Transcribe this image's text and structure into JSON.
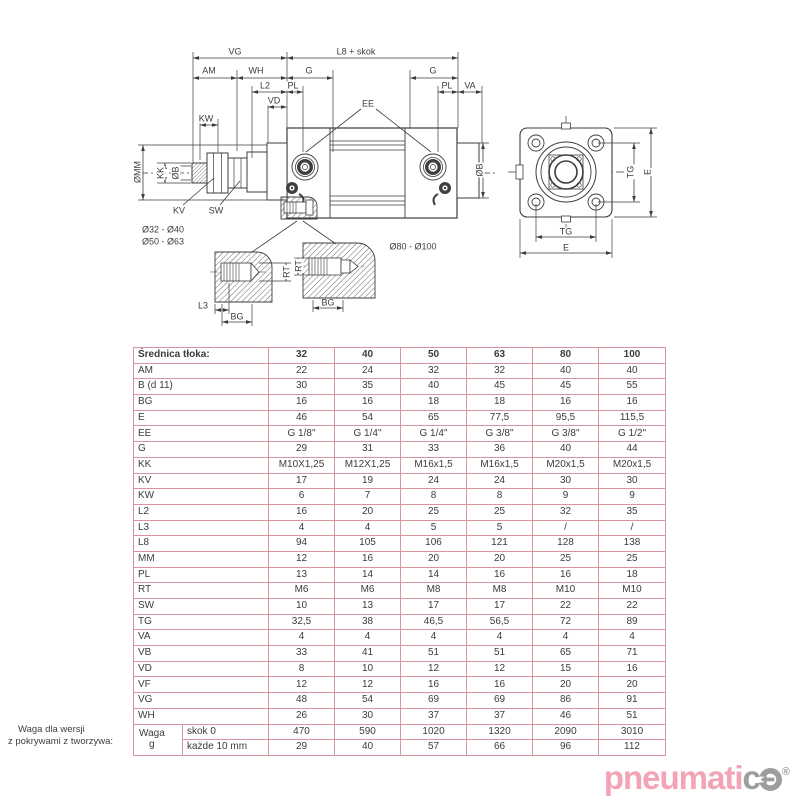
{
  "colors": {
    "line": "#3d3d3d",
    "table_border": "#d9949e",
    "text": "#3c3c3c",
    "logo_pink": "#f3a3b5",
    "logo_gray": "#9d9d9c"
  },
  "diagram": {
    "labels": [
      {
        "text": "VG",
        "x": 235,
        "y": 52
      },
      {
        "text": "L8 + skok",
        "x": 356,
        "y": 52
      },
      {
        "text": "AM",
        "x": 209,
        "y": 71
      },
      {
        "text": "WH",
        "x": 256,
        "y": 71
      },
      {
        "text": "G",
        "x": 309,
        "y": 71
      },
      {
        "text": "G",
        "x": 433,
        "y": 71
      },
      {
        "text": "L2",
        "x": 265,
        "y": 86
      },
      {
        "text": "PL",
        "x": 293,
        "y": 86
      },
      {
        "text": "PL",
        "x": 447,
        "y": 86
      },
      {
        "text": "VA",
        "x": 470,
        "y": 86
      },
      {
        "text": "VD",
        "x": 274,
        "y": 101
      },
      {
        "text": "KW",
        "x": 206,
        "y": 119
      },
      {
        "text": "EE",
        "x": 368,
        "y": 104
      },
      {
        "text": "ØMM",
        "x": 138,
        "y": 172,
        "rot": true
      },
      {
        "text": "KK",
        "x": 161,
        "y": 173,
        "rot": true
      },
      {
        "text": "ØB",
        "x": 176,
        "y": 173,
        "rot": true
      },
      {
        "text": "KV",
        "x": 179,
        "y": 211
      },
      {
        "text": "SW",
        "x": 216,
        "y": 211
      },
      {
        "text": "Ø32 - Ø40",
        "x": 163,
        "y": 230
      },
      {
        "text": "Ø50 - Ø63",
        "x": 163,
        "y": 242
      },
      {
        "text": "Ø80 - Ø100",
        "x": 413,
        "y": 247
      },
      {
        "text": "ØB",
        "x": 480,
        "y": 170,
        "rot": true
      },
      {
        "text": "TG",
        "x": 631,
        "y": 172,
        "rot": true
      },
      {
        "text": "E",
        "x": 648,
        "y": 172,
        "rot": true
      },
      {
        "text": "TG",
        "x": 566,
        "y": 232
      },
      {
        "text": "E",
        "x": 566,
        "y": 248
      },
      {
        "text": "RT",
        "x": 287,
        "y": 272,
        "rot": true
      },
      {
        "text": "RT",
        "x": 299,
        "y": 266,
        "rot": true
      },
      {
        "text": "L3",
        "x": 203,
        "y": 306
      },
      {
        "text": "BG",
        "x": 237,
        "y": 317
      },
      {
        "text": "BG",
        "x": 328,
        "y": 303
      }
    ]
  },
  "table": {
    "header": [
      "Średnica tłoka:",
      "32",
      "40",
      "50",
      "63",
      "80",
      "100"
    ],
    "rows": [
      {
        "label": "AM",
        "values": [
          "22",
          "24",
          "32",
          "32",
          "40",
          "40"
        ]
      },
      {
        "label": "B (d 11)",
        "values": [
          "30",
          "35",
          "40",
          "45",
          "45",
          "55"
        ]
      },
      {
        "label": "BG",
        "values": [
          "16",
          "16",
          "18",
          "18",
          "16",
          "16"
        ]
      },
      {
        "label": "E",
        "values": [
          "46",
          "54",
          "65",
          "77,5",
          "95,5",
          "115,5"
        ]
      },
      {
        "label": "EE",
        "values": [
          "G 1/8\"",
          "G 1/4\"",
          "G 1/4\"",
          "G 3/8\"",
          "G 3/8\"",
          "G 1/2\""
        ]
      },
      {
        "label": "G",
        "values": [
          "29",
          "31",
          "33",
          "36",
          "40",
          "44"
        ]
      },
      {
        "label": "KK",
        "values": [
          "M10X1,25",
          "M12X1,25",
          "M16x1,5",
          "M16x1,5",
          "M20x1,5",
          "M20x1,5"
        ]
      },
      {
        "label": "KV",
        "values": [
          "17",
          "19",
          "24",
          "24",
          "30",
          "30"
        ]
      },
      {
        "label": "KW",
        "values": [
          "6",
          "7",
          "8",
          "8",
          "9",
          "9"
        ]
      },
      {
        "label": "L2",
        "values": [
          "16",
          "20",
          "25",
          "25",
          "32",
          "35"
        ]
      },
      {
        "label": "L3",
        "values": [
          "4",
          "4",
          "5",
          "5",
          "/",
          "/"
        ]
      },
      {
        "label": "L8",
        "values": [
          "94",
          "105",
          "106",
          "121",
          "128",
          "138"
        ]
      },
      {
        "label": "MM",
        "values": [
          "12",
          "16",
          "20",
          "20",
          "25",
          "25"
        ]
      },
      {
        "label": "PL",
        "values": [
          "13",
          "14",
          "14",
          "16",
          "16",
          "18"
        ]
      },
      {
        "label": "RT",
        "values": [
          "M6",
          "M6",
          "M8",
          "M8",
          "M10",
          "M10"
        ]
      },
      {
        "label": "SW",
        "values": [
          "10",
          "13",
          "17",
          "17",
          "22",
          "22"
        ]
      },
      {
        "label": "TG",
        "values": [
          "32,5",
          "38",
          "46,5",
          "56,5",
          "72",
          "89"
        ]
      },
      {
        "label": "VA",
        "values": [
          "4",
          "4",
          "4",
          "4",
          "4",
          "4"
        ]
      },
      {
        "label": "VB",
        "values": [
          "33",
          "41",
          "51",
          "51",
          "65",
          "71"
        ]
      },
      {
        "label": "VD",
        "values": [
          "8",
          "10",
          "12",
          "12",
          "15",
          "16"
        ]
      },
      {
        "label": "VF",
        "values": [
          "12",
          "12",
          "16",
          "16",
          "20",
          "20"
        ]
      },
      {
        "label": "VG",
        "values": [
          "48",
          "54",
          "69",
          "69",
          "86",
          "91"
        ]
      },
      {
        "label": "WH",
        "values": [
          "26",
          "30",
          "37",
          "37",
          "46",
          "51"
        ]
      }
    ],
    "weight": {
      "label": "Waga",
      "unit": "g",
      "sub_rows": [
        {
          "label": "skok 0",
          "values": [
            "470",
            "590",
            "1020",
            "1320",
            "2090",
            "3010"
          ]
        },
        {
          "label": "każde 10 mm",
          "values": [
            "29",
            "40",
            "57",
            "66",
            "96",
            "112"
          ]
        }
      ]
    }
  },
  "footnote": {
    "line1": "Waga dla wersji",
    "line2": "z pokrywami z tworzywa:"
  },
  "logo": {
    "part_pink": "pneumati",
    "part_gray": "c",
    "reg": "®"
  }
}
